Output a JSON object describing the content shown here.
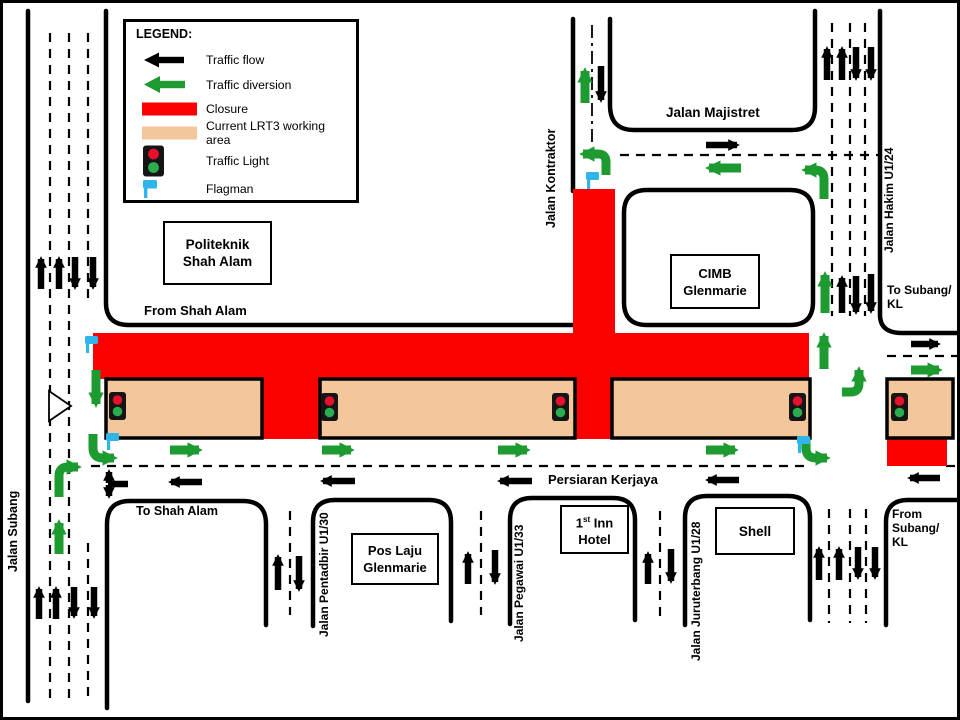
{
  "colors": {
    "closure_red": "#FB0000",
    "work_area_peach": "#F3C69C",
    "diversion_green": "#1D9B31",
    "flag_blue": "#2FB5EA",
    "light_red": "#E8112D",
    "light_green": "#2BAD4E",
    "road_black": "#000000"
  },
  "legend": {
    "title": "LEGEND:",
    "items": [
      {
        "icon": "traffic-flow-arrow",
        "label": "Traffic flow"
      },
      {
        "icon": "traffic-diversion-arrow",
        "label": "Traffic diversion"
      },
      {
        "icon": "closure-bar",
        "label": "Closure"
      },
      {
        "icon": "working-area-bar",
        "label": "Current LRT3 working area"
      },
      {
        "icon": "traffic-light",
        "label": "Traffic Light"
      },
      {
        "icon": "flagman-flag",
        "label": "Flagman"
      }
    ]
  },
  "labels": {
    "politeknik": [
      "Politeknik",
      "Shah Alam"
    ],
    "cimb": [
      "CIMB",
      "Glenmarie"
    ],
    "pos_laju": [
      "Pos Laju",
      "Glenmarie"
    ],
    "inn": {
      "num": "1",
      "sup": "st",
      "rest": " Inn",
      "line2": "Hotel"
    },
    "shell": "Shell",
    "from_shah_alam": "From Shah Alam",
    "to_shah_alam": "To Shah Alam",
    "to_subang_kl": [
      "To Subang/",
      "KL"
    ],
    "from_subang_kl": [
      "From",
      "Subang/",
      "KL"
    ],
    "persiaran_kerjaya": "Persiaran Kerjaya",
    "jalan_subang": "Jalan Subang",
    "jalan_kontraktor": "Jalan Kontraktor",
    "jalan_majistret": "Jalan Majistret",
    "jalan_hakim": "Jalan Hakim U1/24",
    "jalan_pentadbir": "Jalan Pentadbir U1/30",
    "jalan_pegawai": "Jalan Pegawai U1/33",
    "jalan_juruterbang": "Jalan Juruterbang U1/28"
  },
  "map": {
    "roads": [
      "M103,8 V300 Q103,322 126,322 H570",
      "M570,16 V188",
      "M607,16 V102 Q607,127 631,127 H789 Q812,127 812,104 V8",
      "M877,8 V312 Q877,330 899,330 H958",
      "M644,187 H787 Q810,187 810,210 V299 Q810,322 787,322 H644 Q621,322 621,299 V210 Q621,187 644,187 Z",
      "M104,705 V521 Q104,498 127,498 H240 Q263,498 263,521 V622",
      "M310,623 V519 Q310,497 332,497 H426 Q448,497 448,519 V618",
      "M507,621 V517 Q507,495 529,495 H610 Q632,495 632,517 V617",
      "M682,622 V515 Q682,493 704,493 H785 Q807,493 807,515 V617",
      "M883,622 V519 Q883,497 905,497 H958",
      "M25,8 V698"
    ],
    "dashed": [
      "M47,30 V700",
      "M66,30 V700",
      "M85,30 V300",
      "M85,540 V700",
      "M617,152 H876",
      "M884,353 H956",
      "M88,463 H803",
      "M943,463 H956",
      "M829,20 V313",
      "M847,20 V313",
      "M862,20 V313",
      "M826,506 V620",
      "M847,506 V620",
      "M863,506 V620",
      "M287,508 V612",
      "M478,508 V612",
      "M657,508 V616"
    ],
    "dashdot": [
      "M589,22 V140"
    ],
    "closures": [
      [
        90,
        330,
        716,
        46
      ],
      [
        570,
        186,
        42,
        146
      ],
      [
        259,
        376,
        58,
        60
      ],
      [
        572,
        376,
        37,
        60
      ],
      [
        884,
        436,
        60,
        27
      ]
    ],
    "work_areas": [
      [
        103,
        376,
        156,
        59
      ],
      [
        317,
        376,
        255,
        59
      ],
      [
        609,
        376,
        198,
        59
      ],
      [
        884,
        376,
        66,
        59
      ]
    ],
    "traffic_lights": [
      [
        106,
        389
      ],
      [
        318,
        390
      ],
      [
        549,
        390
      ],
      [
        786,
        390
      ],
      [
        888,
        390
      ]
    ],
    "flagmen": [
      [
        82,
        333
      ],
      [
        103,
        430
      ],
      [
        583,
        169
      ],
      [
        794,
        433
      ]
    ],
    "yield_triangle": "M46,388 L68,403 L46,418 Z",
    "arrows": [
      {
        "c": "g",
        "p": [
          582,
          100,
          582,
          68
        ]
      },
      {
        "c": "g",
        "p": [
          738,
          165,
          706,
          165
        ]
      },
      {
        "c": "g",
        "p": [
          822,
          310,
          822,
          272
        ]
      },
      {
        "c": "g",
        "p": [
          821,
          366,
          821,
          333
        ]
      },
      {
        "c": "g",
        "p": [
          908,
          367,
          936,
          367
        ]
      },
      {
        "c": "g",
        "p": [
          167,
          447,
          196,
          447
        ]
      },
      {
        "c": "g",
        "p": [
          319,
          447,
          348,
          447
        ]
      },
      {
        "c": "g",
        "p": [
          495,
          447,
          524,
          447
        ]
      },
      {
        "c": "g",
        "p": [
          703,
          447,
          732,
          447
        ]
      },
      {
        "c": "g",
        "p": [
          93,
          367,
          93,
          401
        ]
      },
      {
        "c": "g",
        "p": [
          56,
          551,
          56,
          520
        ]
      },
      {
        "c": "k",
        "p": [
          598,
          63,
          598,
          97
        ]
      },
      {
        "c": "k",
        "p": [
          703,
          142,
          734,
          142
        ]
      },
      {
        "c": "k",
        "p": [
          824,
          77,
          824,
          46
        ]
      },
      {
        "c": "k",
        "p": [
          839,
          77,
          839,
          46
        ]
      },
      {
        "c": "k",
        "p": [
          853,
          44,
          853,
          75
        ]
      },
      {
        "c": "k",
        "p": [
          868,
          44,
          868,
          75
        ]
      },
      {
        "c": "k",
        "p": [
          839,
          310,
          839,
          275
        ]
      },
      {
        "c": "k",
        "p": [
          853,
          273,
          853,
          309
        ]
      },
      {
        "c": "k",
        "p": [
          868,
          271,
          868,
          308
        ]
      },
      {
        "c": "k",
        "p": [
          908,
          341,
          935,
          341
        ]
      },
      {
        "c": "k",
        "p": [
          199,
          479,
          168,
          479
        ]
      },
      {
        "c": "k",
        "p": [
          352,
          478,
          320,
          478
        ]
      },
      {
        "c": "k",
        "p": [
          529,
          478,
          497,
          478
        ]
      },
      {
        "c": "k",
        "p": [
          736,
          477,
          705,
          477
        ]
      },
      {
        "c": "k",
        "p": [
          937,
          475,
          907,
          475
        ]
      },
      {
        "c": "k",
        "p": [
          38,
          286,
          38,
          256
        ]
      },
      {
        "c": "k",
        "p": [
          56,
          286,
          56,
          256
        ]
      },
      {
        "c": "k",
        "p": [
          72,
          254,
          72,
          284
        ]
      },
      {
        "c": "k",
        "p": [
          90,
          254,
          90,
          284
        ]
      },
      {
        "c": "k",
        "p": [
          36,
          616,
          36,
          586
        ]
      },
      {
        "c": "k",
        "p": [
          53,
          616,
          53,
          586
        ]
      },
      {
        "c": "k",
        "p": [
          71,
          584,
          71,
          613
        ]
      },
      {
        "c": "k",
        "p": [
          91,
          584,
          91,
          613
        ]
      },
      {
        "c": "k",
        "p": [
          275,
          587,
          275,
          554
        ]
      },
      {
        "c": "k",
        "p": [
          296,
          553,
          296,
          586
        ]
      },
      {
        "c": "k",
        "p": [
          465,
          581,
          465,
          551
        ]
      },
      {
        "c": "k",
        "p": [
          492,
          547,
          492,
          579
        ]
      },
      {
        "c": "k",
        "p": [
          645,
          581,
          645,
          551
        ]
      },
      {
        "c": "k",
        "p": [
          668,
          546,
          668,
          578
        ]
      },
      {
        "c": "k",
        "p": [
          816,
          577,
          816,
          546
        ]
      },
      {
        "c": "k",
        "p": [
          836,
          577,
          836,
          546
        ]
      },
      {
        "c": "k",
        "p": [
          855,
          544,
          855,
          574
        ]
      },
      {
        "c": "k",
        "p": [
          872,
          544,
          872,
          574
        ]
      },
      {
        "c": "k",
        "p": [
          106,
          480,
          106,
          469
        ]
      },
      {
        "c": "k",
        "p": [
          106,
          482,
          106,
          493
        ]
      },
      {
        "c": "k",
        "p": [
          125,
          481,
          105,
          481
        ],
        "h": "n"
      }
    ],
    "turns": [
      "M603,172 V159 Q603,151 595,151 H580",
      "M821,196 V176 Q821,167 812,167 H802",
      "M839,389 H848 Q856,389 856,380 V367",
      "M90,431 V445 Q90,455 100,455 H111",
      "M56,494 V473 Q56,464 65,464 H75",
      "M803,435 V445 Q803,455 813,455 H824"
    ]
  }
}
